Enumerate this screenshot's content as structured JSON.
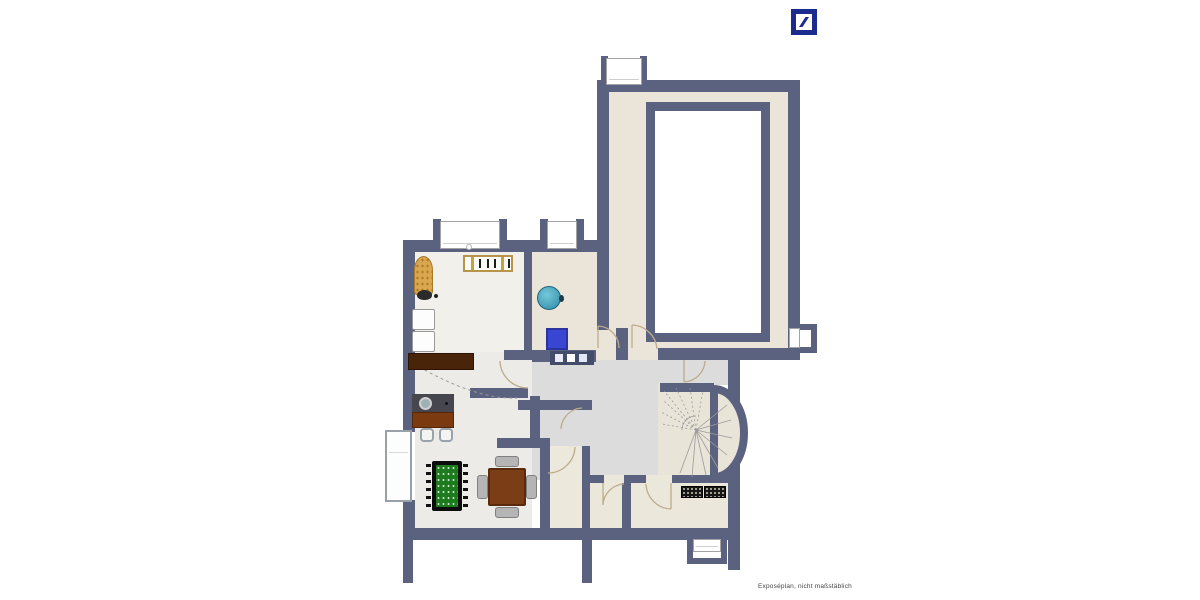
{
  "window": {
    "background": "#ffffff"
  },
  "brand": {
    "logo": "deutsche-bank-logo",
    "logo_color": "#1b2c8e"
  },
  "footer": {
    "disclaimer": "Exposéplan, nicht maßstäblich"
  },
  "floorplan": {
    "type": "basement floor plan (no text labels shown)",
    "colors": {
      "wall": "#5a6280",
      "floor_cream": "#eae5d8",
      "floor_laundry": "#f1f0ea",
      "floor_hobby": "#ecebe7",
      "floor_hall_gray": "#dcdcdc",
      "door_swing_arc": "#bcab8b",
      "accent_blue_square": "#3946d2",
      "accent_teal_tank": "#3a9fba",
      "foosball_green": "#1e7a1e",
      "bar_brown": "#7b3a10",
      "bench_brown": "#4a2408"
    },
    "rooms": [
      "pool-room-with-void",
      "laundry-room",
      "boiler-room",
      "hobby-room",
      "hallway",
      "storage-room",
      "cellar-room",
      "spiral-stair-area"
    ],
    "furniture_icons": [
      "ironing-board",
      "iron",
      "clothes-drying-rack",
      "washing-machine",
      "dryer",
      "boiler-tank",
      "blue-cabinet",
      "wall-radiator",
      "wall-bench",
      "bar-counter",
      "bar-sink",
      "bar-stool",
      "bar-stool",
      "foosball-table",
      "dining-table",
      "chair",
      "chair",
      "chair",
      "chair",
      "radiator",
      "radiator",
      "spiral-staircase"
    ],
    "features": [
      "window-bays",
      "door-swing-arcs",
      "dashed-opening-arc",
      "stair-treads"
    ]
  }
}
